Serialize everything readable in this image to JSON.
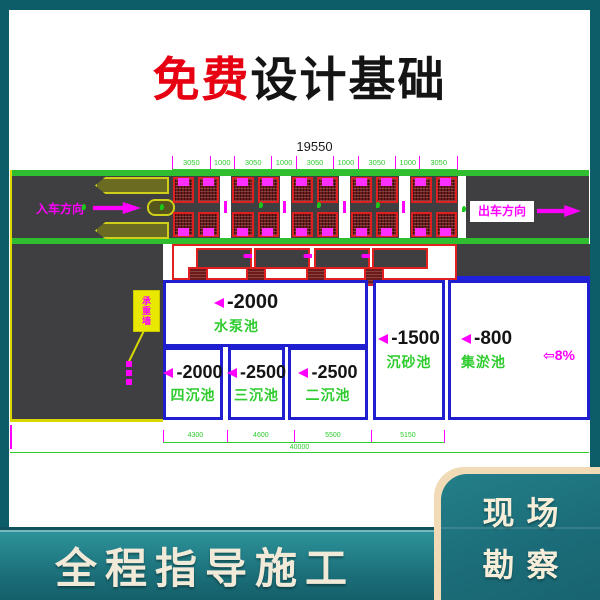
{
  "title": {
    "free": "免费",
    "rest": "设计基础"
  },
  "diagram": {
    "dim_total": "19550",
    "dim_segments": [
      "3050",
      "1000",
      "3050",
      "1000",
      "3050",
      "1000",
      "3050",
      "1000",
      "3050"
    ],
    "entry_label": "入车方向",
    "exit_label": "出车方向",
    "callout_label": "承重墙",
    "pools": {
      "pump": {
        "depth": "-2000",
        "name": "水泵池"
      },
      "sink4": {
        "depth": "-2000",
        "name": "四沉池"
      },
      "sink3": {
        "depth": "-2500",
        "name": "三沉池"
      },
      "sink2": {
        "depth": "-2500",
        "name": "二沉池"
      },
      "sand": {
        "depth": "-1500",
        "name": "沉砂池"
      },
      "silt": {
        "depth": "-800",
        "name": "集淤池"
      }
    },
    "slope": {
      "arrow": "⇦",
      "value": "8%"
    },
    "bottom_dims": [
      "4300",
      "4600",
      "5500",
      "5150"
    ],
    "bottom_total": "40000",
    "colors": {
      "line_green": "#2ecc2e",
      "magenta": "#ff00ff",
      "pool_blue": "#1f1fd0",
      "hatch_red": "#e02020",
      "road_gray": "#3f3f42",
      "island_yellow": "#d8d800",
      "accent_red": "#e60012",
      "teal_bg": "#0d5d68",
      "cream": "#f2ead8"
    }
  },
  "footer": {
    "slogan": "全程指导施工"
  },
  "corner": {
    "line1": "现场",
    "line2": "勘察"
  }
}
